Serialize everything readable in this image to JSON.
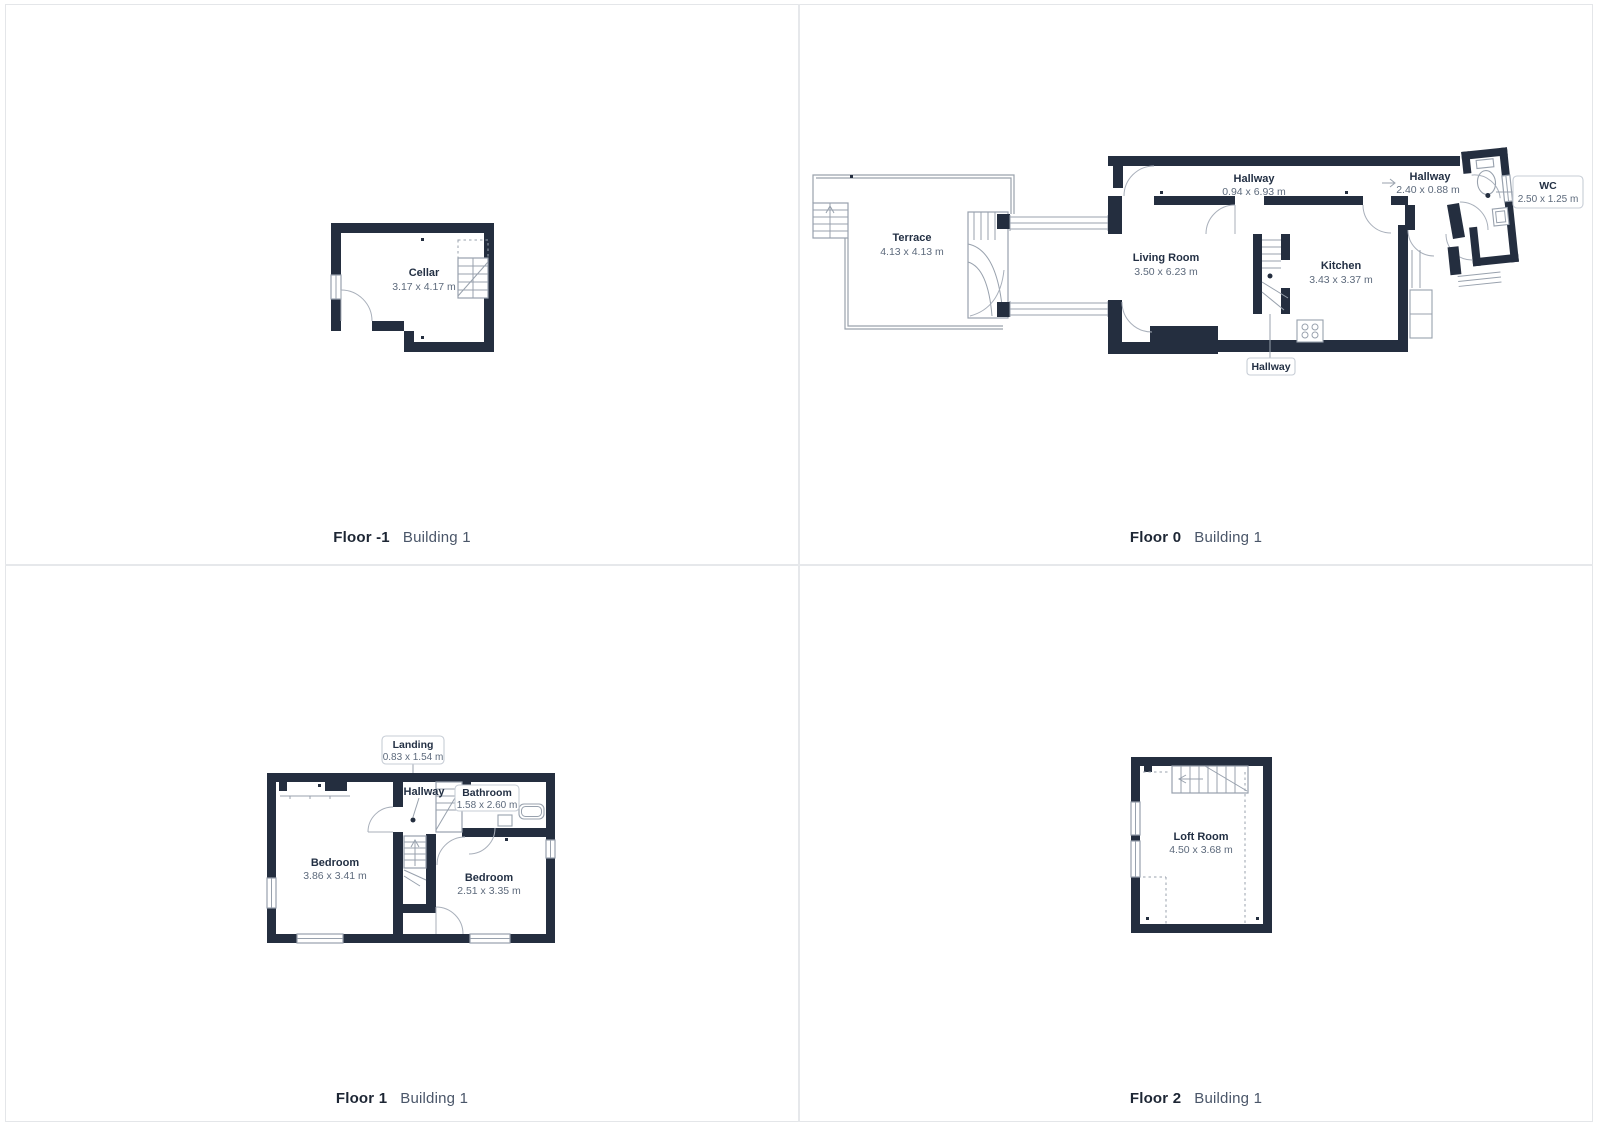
{
  "panels": [
    {
      "floor": "Floor -1",
      "building": "Building 1"
    },
    {
      "floor": "Floor 0",
      "building": "Building 1"
    },
    {
      "floor": "Floor 1",
      "building": "Building 1"
    },
    {
      "floor": "Floor 2",
      "building": "Building 1"
    }
  ],
  "rooms": {
    "cellar": {
      "name": "Cellar",
      "dims": "3.17 x 4.17 m"
    },
    "terrace": {
      "name": "Terrace",
      "dims": "4.13 x 4.13 m"
    },
    "hallway0_long": {
      "name": "Hallway",
      "dims": "0.94 x 6.93 m"
    },
    "hallway0_small": {
      "name": "Hallway",
      "dims": "2.40 x 0.88 m"
    },
    "wc": {
      "name": "WC",
      "dims": "2.50 x 1.25 m"
    },
    "living_room": {
      "name": "Living Room",
      "dims": "3.50 x 6.23 m"
    },
    "kitchen": {
      "name": "Kitchen",
      "dims": "3.43 x 3.37 m"
    },
    "hallway0_tag": {
      "name": "Hallway"
    },
    "landing": {
      "name": "Landing",
      "dims": "0.83 x 1.54 m"
    },
    "hallway1": {
      "name": "Hallway"
    },
    "bathroom": {
      "name": "Bathroom",
      "dims": "1.58 x 2.60 m"
    },
    "bedroom_left": {
      "name": "Bedroom",
      "dims": "3.86 x 3.41 m"
    },
    "bedroom_right": {
      "name": "Bedroom",
      "dims": "2.51 x 3.35 m"
    },
    "loft": {
      "name": "Loft Room",
      "dims": "4.50 x 3.68 m"
    }
  },
  "colors": {
    "wall": "#242e3f",
    "thin_line": "#98a1ad",
    "room_name_text": "#233044",
    "room_dims_text": "#5d6a7c",
    "caption_floor_text": "#1d2634",
    "caption_building_text": "#4a5669",
    "divider": "#e6e8eb",
    "tag_border": "#c7cdd6"
  }
}
